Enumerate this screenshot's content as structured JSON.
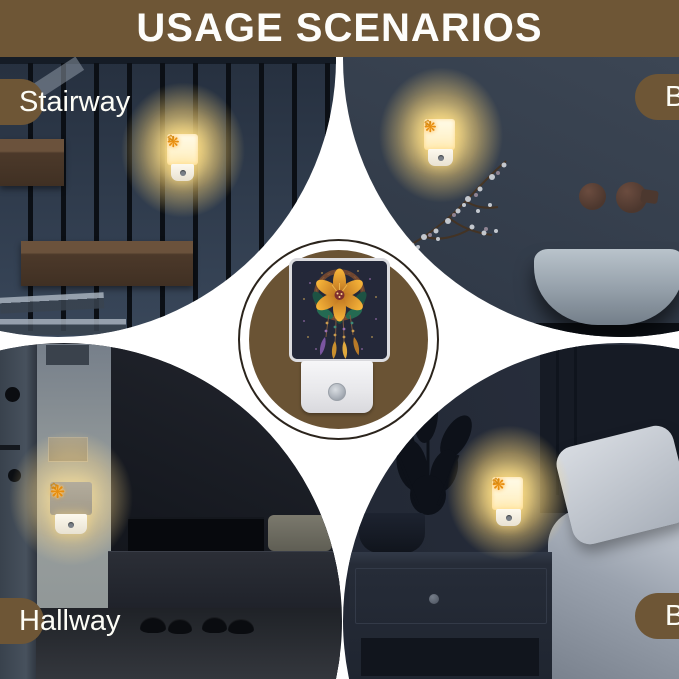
{
  "title": "USAGE SCENARIOS",
  "scenes": {
    "stairway": {
      "label": "Stairway"
    },
    "bathroom": {
      "label": "Bathroom"
    },
    "hallway": {
      "label": "Hallway"
    },
    "bedroom": {
      "label": "Bedroom"
    }
  },
  "night_light": {
    "flower_glyph": "❋",
    "sprig_glyph": "✿"
  },
  "colors": {
    "brown": "#6e5636",
    "medallion_brown": "#6a5334",
    "medallion_outline": "#2b241c",
    "glow": "#ffdf8e",
    "title_text": "#fdfdfb",
    "label_text": "#fdfdf6",
    "artwork_background": "#242839"
  }
}
